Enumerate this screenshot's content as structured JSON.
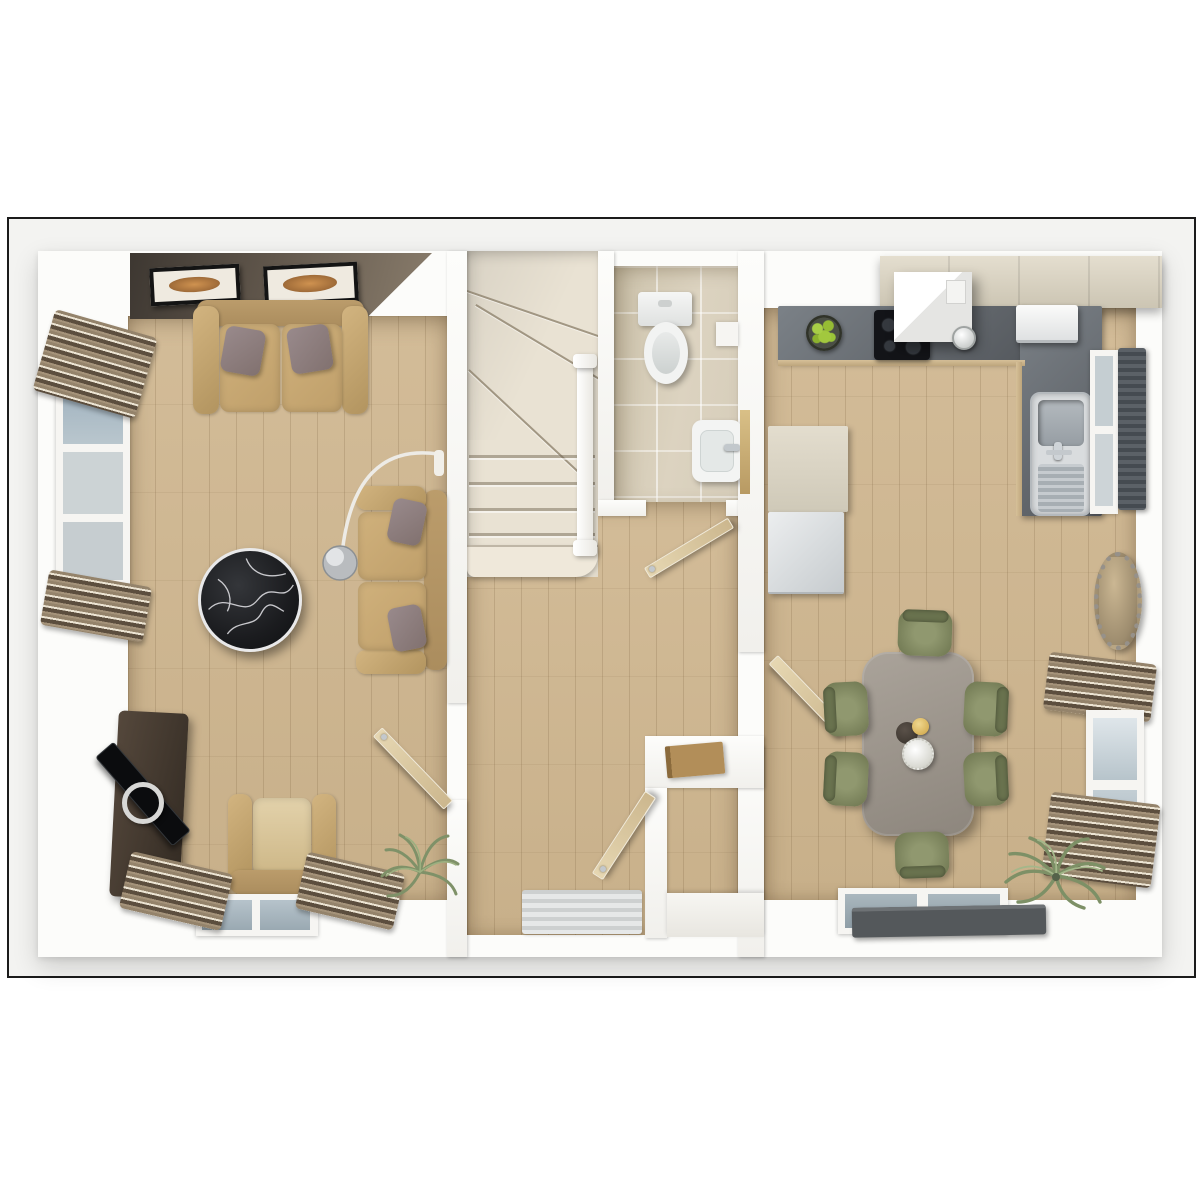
{
  "scene": {
    "title": "Ground floor 3D floor plan, top-down dollhouse render",
    "rooms": [
      {
        "id": "living",
        "label": "Living room"
      },
      {
        "id": "hall",
        "label": "Hallway and staircase"
      },
      {
        "id": "wc",
        "label": "Cloakroom WC"
      },
      {
        "id": "kitchen",
        "label": "Kitchen and dining room"
      }
    ]
  },
  "palette": {
    "page_bg": "#ffffff",
    "frame_border": "#1b1b1b",
    "frame_bg": "#f3f3f1",
    "wall_white": "#fbfbf8",
    "wood_floor": "#cdb692",
    "tile_floor": "#d8cfbc",
    "stair_carpet": "#e9e2d3",
    "accent_wall_dark": "#433c34",
    "sofa_tan": "#c5a671",
    "pillow_grey": "#8e7f81",
    "marble_black": "#1d1e20",
    "worktop_grey": "#62686d",
    "cabinet_cream": "#d9d2c2",
    "appliance_white": "#f2f3f2",
    "dining_table_grey": "#9a938a",
    "chair_olive": "#87906b",
    "curtain_bronze": "#8a7962",
    "window_glass": "#aeb9c0",
    "rug_dark": "#54585b",
    "plant_green": "#7d9066",
    "door_timber": "#d3c09c",
    "gold_accent": "#dec07a",
    "apple_green": "#9dc23c"
  },
  "living": {
    "label": "Living room",
    "items": {
      "accent_wall": "Dark feature wall",
      "artwork_1": "Framed artwork",
      "artwork_2": "Framed artwork",
      "sofa_large": "Two-cushion fabric sofa",
      "sofa_small": "Two-seat sofa",
      "coffee_table": "Round black marble coffee table",
      "arc_lamp": "Chrome arc floor lamp",
      "tv_unit": "Dark wood media unit with TV",
      "armchair": "Tan armchair",
      "fern": "Potted fern",
      "window_left": "Tall side window with gathered curtains",
      "window_front": "Front window with gathered curtains",
      "door": "Open door to hallway"
    }
  },
  "hall": {
    "label": "Hallway and staircase",
    "items": {
      "stairs": "Carpeted winder staircase with white handrail",
      "front_door": "Open front entrance door",
      "doormat": "Striped doormat",
      "console": "Under-stair ledge with book",
      "door_living": "Doorway to living room",
      "door_kitchen": "Doorway to kitchen"
    }
  },
  "wc": {
    "label": "Cloakroom WC",
    "items": {
      "toilet": "Toilet with cistern",
      "basin": "Wash basin with chrome tap",
      "ledge": "Timber vanity ledge",
      "shelf": "Wall shelf",
      "door": "Open WC door"
    }
  },
  "kitchen": {
    "label": "Kitchen and dining room",
    "items": {
      "upper_cabinets": "Cream wall cabinets",
      "worktop_top": "Dark stone worktop",
      "worktop_right": "Dark stone worktop return",
      "hob": "Black induction hob",
      "extractor": "White extractor hood",
      "kettle": "Kettle",
      "fruit_bowl": "Bowl of green apples",
      "small_appliance": "Countertop appliance",
      "sink": "Stainless steel sink with drainer",
      "tall_unit": "Cream tall larder unit",
      "fridge": "Fridge freezer",
      "radiator": "Dark wall radiator",
      "window_side": "Side window",
      "dining_table": "Grey six-seat dining table",
      "chair_count": "6",
      "chair": "Olive dining chair",
      "centerpiece_bowl": "Dark bowl",
      "centerpiece_plate": "Gold dish",
      "centerpiece_flowers": "White flower posy",
      "mirror": "Oval beaded wall mirror",
      "window_rear": "Rear window with gathered curtains",
      "palm": "Potted palm",
      "french_door": "Rear glazed french door",
      "rug": "Dark grey runner rug"
    }
  }
}
